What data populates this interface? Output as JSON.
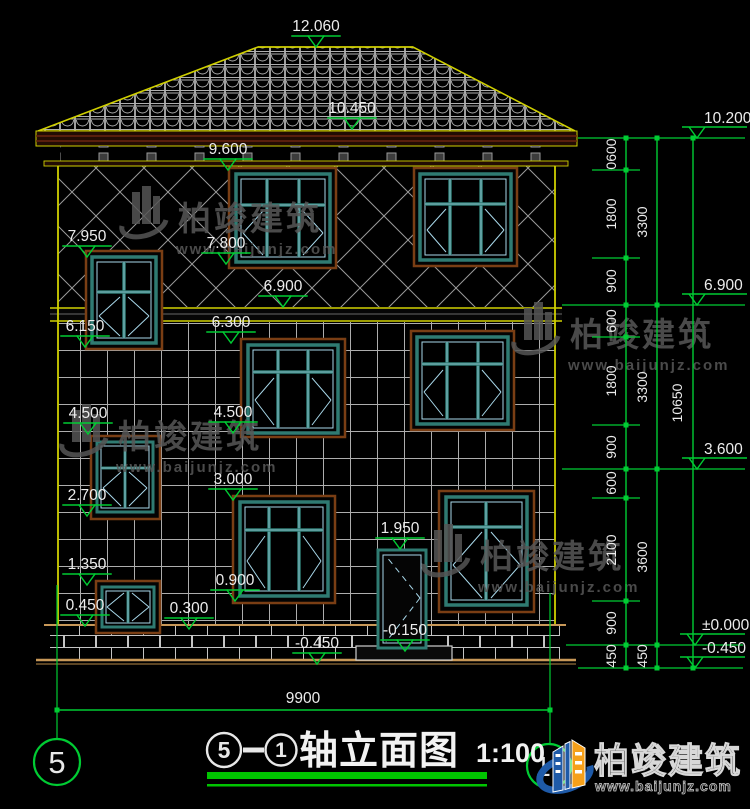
{
  "meta": {
    "drawing_type": "building front elevation (CAD)"
  },
  "watermark": {
    "brand": "柏竣建筑",
    "url": "www.baijunjz.com"
  },
  "logo": {
    "brand": "柏竣建筑",
    "url": "www.baijunjz.com"
  },
  "title_block": {
    "axis_start": "5",
    "dash": "—",
    "axis_end": "1",
    "name": "轴立面图",
    "scale": "1:100"
  },
  "sheet_bubble": "5",
  "axis_bubble_right": "1",
  "dims": {
    "elevations": [
      "12.060",
      "10.450",
      "9.600",
      "7.950",
      "7.800",
      "6.900",
      "6.300",
      "6.150",
      "4.500",
      "4.500",
      "3.000",
      "2.700",
      "1.950",
      "1.350",
      "0.900",
      "0.450",
      "0.300",
      "-0.150",
      "-0.450"
    ],
    "bottom_width": "9900"
  },
  "right_chain": {
    "col1": [
      "0600",
      "1800",
      "900",
      "600",
      "1800",
      "900",
      "600",
      "2100",
      "900",
      "450"
    ],
    "col2": [
      "3300",
      "3300",
      "3600",
      "450"
    ],
    "total": "10650",
    "levels": [
      "10.200",
      "6.900",
      "3.600",
      "±0.000",
      "-0.450"
    ]
  },
  "colors": {
    "dimension_green": "#00CC33",
    "outline_yellow": "#CFCF00",
    "window_teal": "#2F7B72",
    "window_light": "#A8D8EA",
    "surround_brown": "#7A3E14",
    "text_white": "#ECECEC",
    "logo_blue": "#1E5AA8",
    "logo_orange": "#F6A01A"
  }
}
